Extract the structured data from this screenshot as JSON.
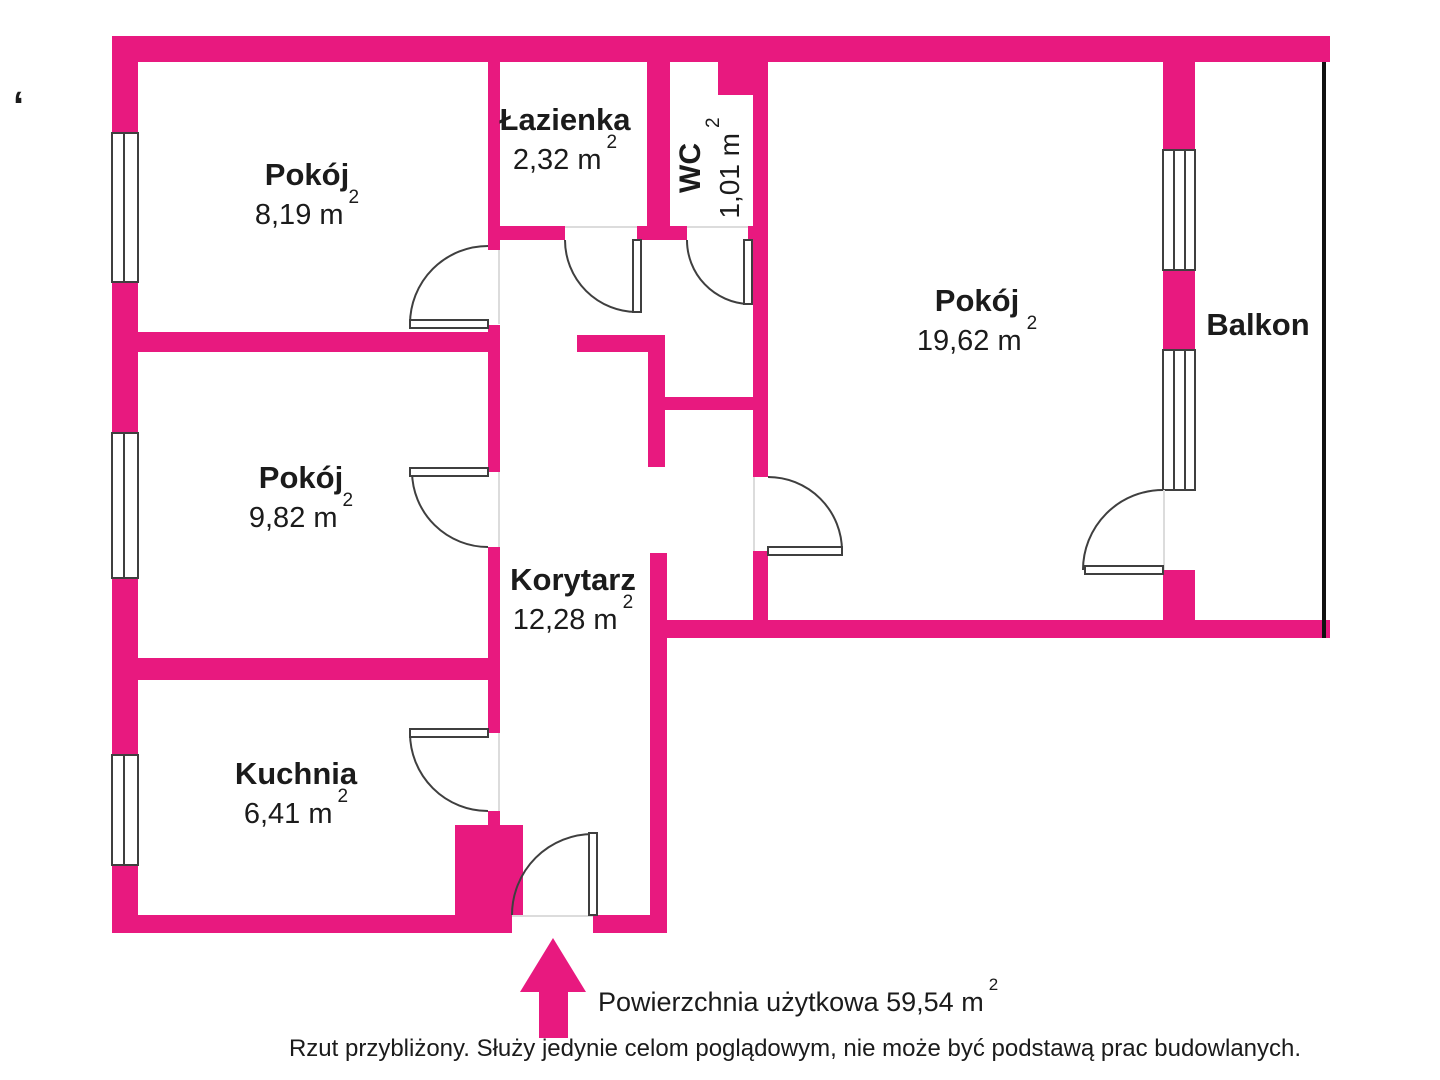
{
  "colors": {
    "wall": "#e8197f",
    "line": "#3f3f3f",
    "bedge": "#111111",
    "text": "#1b1b1b"
  },
  "misc": {
    "corner_tick": "‘"
  },
  "rooms": {
    "pokoj_top": {
      "name": "Pokój",
      "area": "8,19 m",
      "sup": "2"
    },
    "lazienka": {
      "name": "Łazienka",
      "area": "2,32 m",
      "sup": "2"
    },
    "wc": {
      "name": "WC",
      "area": "1,01 m",
      "sup": "2"
    },
    "pokoj_right": {
      "name": "Pokój",
      "area": "19,62 m",
      "sup": "2"
    },
    "balkon": {
      "name": "Balkon"
    },
    "pokoj_mid": {
      "name": "Pokój",
      "area": "9,82 m",
      "sup": "2"
    },
    "korytarz": {
      "name": "Korytarz",
      "area": "12,28 m",
      "sup": "2"
    },
    "kuchnia": {
      "name": "Kuchnia",
      "area": "6,41 m",
      "sup": "2"
    }
  },
  "footer": {
    "total_label": "Powierzchnia użytkowa 59,54 m",
    "total_sup": "2",
    "disclaimer": "Rzut przybliżony. Służy jedynie celom poglądowym, nie może być podstawą prac budowlanych."
  }
}
